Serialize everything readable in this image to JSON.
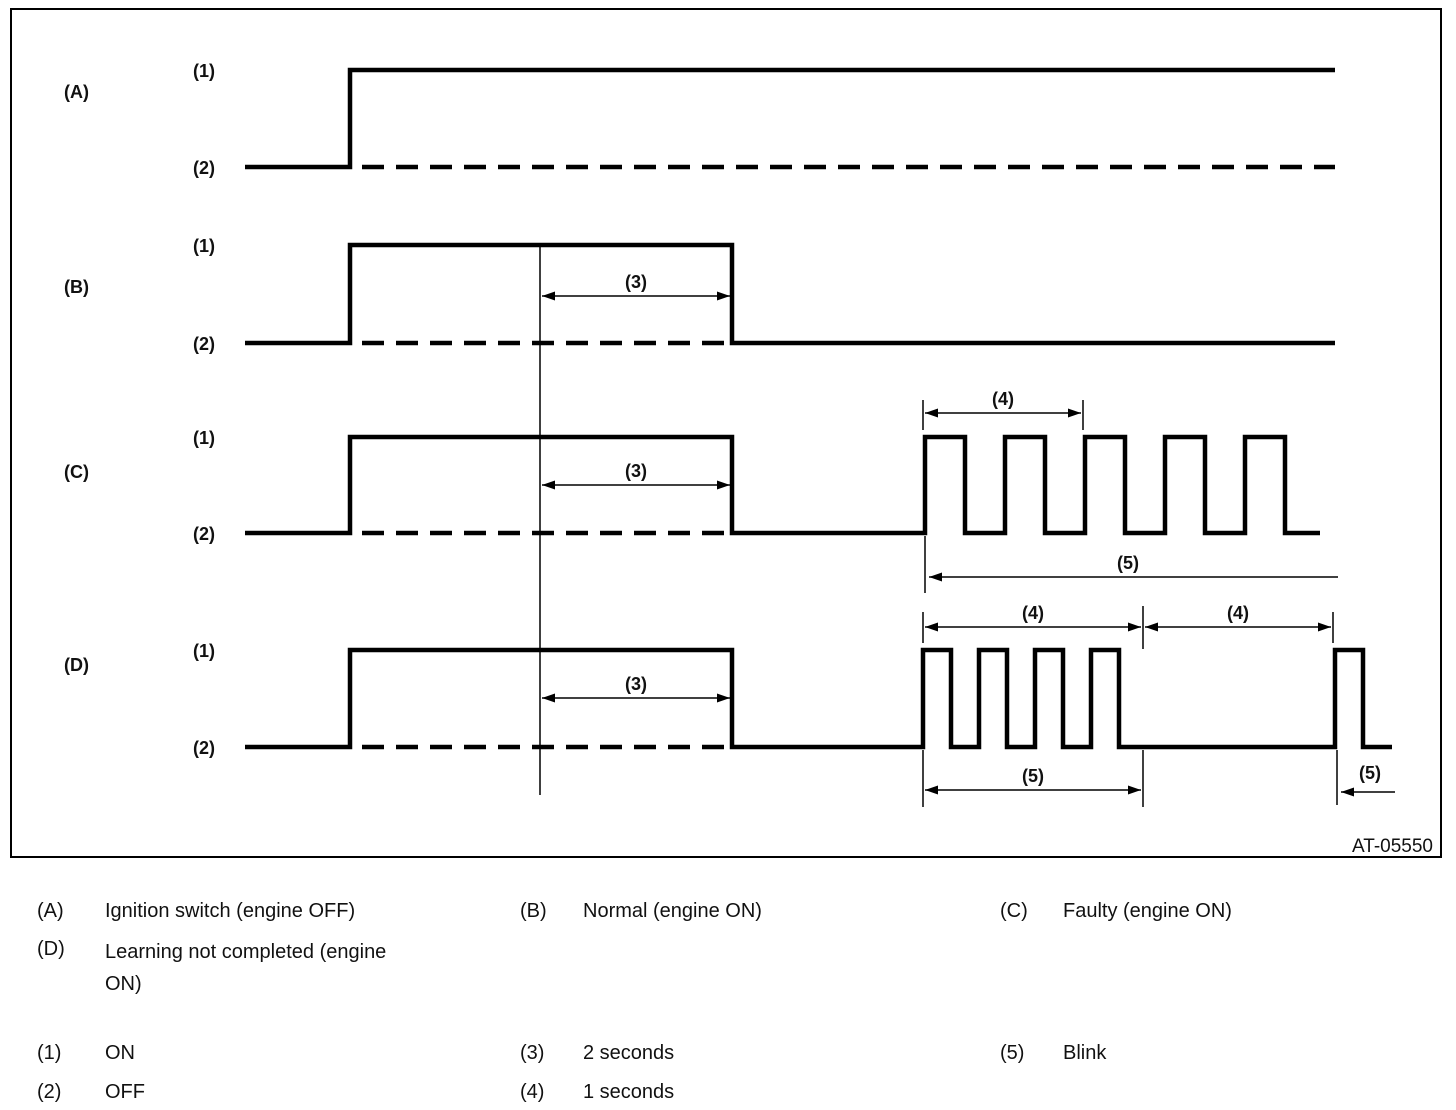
{
  "diagram": {
    "figure_code": "AT-05550",
    "row_labels": {
      "a": "(A)",
      "b": "(B)",
      "c": "(C)",
      "d": "(D)"
    },
    "level_labels": {
      "on": "(1)",
      "off": "(2)"
    },
    "dim_labels": {
      "two_seconds": "(3)",
      "one_second": "(4)",
      "blink": "(5)"
    }
  },
  "legend": {
    "items": [
      {
        "key": "(A)",
        "text": "Ignition switch (engine OFF)"
      },
      {
        "key": "(B)",
        "text": "Normal (engine ON)"
      },
      {
        "key": "(C)",
        "text": "Faulty (engine ON)"
      },
      {
        "key": "(D)",
        "text": "Learning not completed (engine ON)"
      },
      {
        "key": "(1)",
        "text": "ON"
      },
      {
        "key": "(2)",
        "text": "OFF"
      },
      {
        "key": "(3)",
        "text": "2 seconds"
      },
      {
        "key": "(4)",
        "text": "1 seconds"
      },
      {
        "key": "(5)",
        "text": "Blink"
      }
    ]
  },
  "waveforms": [
    {
      "id": "(A)",
      "meaning": "Ignition switch (engine OFF)",
      "pattern": "OFF, then switches ON and stays ON; OFF level continues as dashed reference line"
    },
    {
      "id": "(B)",
      "meaning": "Normal (engine ON)",
      "pattern": "OFF, ON, then turns OFF 2 seconds (3) after reference point and stays OFF"
    },
    {
      "id": "(C)",
      "meaning": "Faulty (engine ON)",
      "pattern": "OFF, ON, OFF 2 seconds (3) after reference, then continuous blink (5): 2 ON/OFF cycles per 1 second (4)"
    },
    {
      "id": "(D)",
      "meaning": "Learning not completed (engine ON)",
      "pattern": "OFF, ON, OFF 2 seconds (3) after reference, then blink (5): 4 quick pulses within 1 second (4), OFF for 1 second (4), repeating"
    }
  ]
}
